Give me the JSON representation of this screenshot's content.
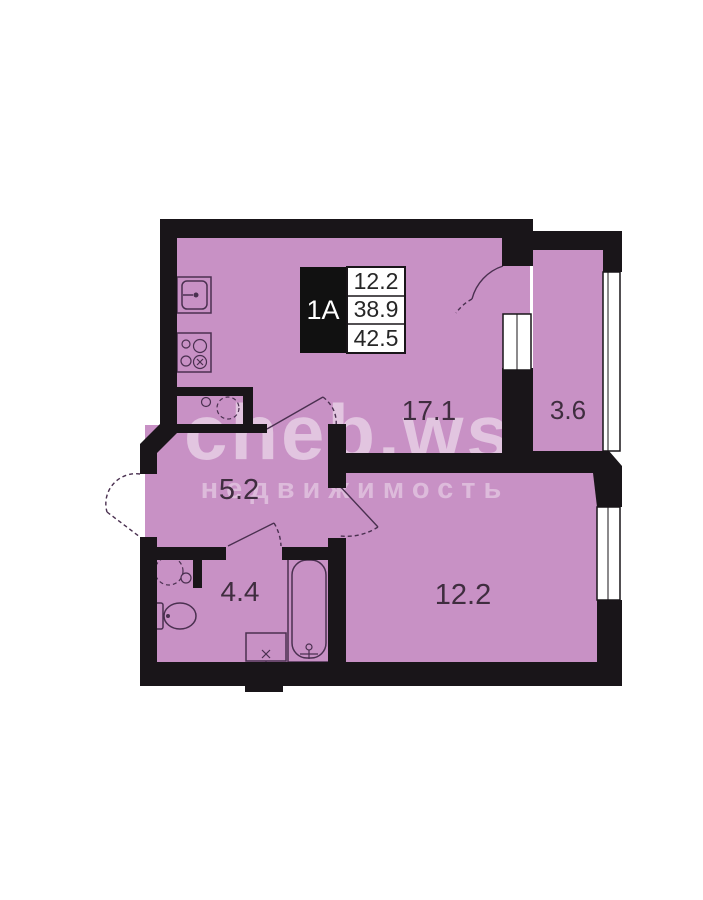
{
  "plan": {
    "unit": "1A",
    "info_values": [
      "12.2",
      "38.9",
      "42.5"
    ],
    "rooms": [
      {
        "id": "living-kitchen",
        "area": "17.1"
      },
      {
        "id": "balcony",
        "area": "3.6"
      },
      {
        "id": "hallway",
        "area": "5.2"
      },
      {
        "id": "bathroom",
        "area": "4.4"
      },
      {
        "id": "bedroom",
        "area": "12.2"
      }
    ]
  },
  "watermark": {
    "line1": "cheb.ws",
    "line2": "недвижимость"
  },
  "colors": {
    "page_bg": "#ffffff",
    "room_fill": "#c891c5",
    "wall": "#191519",
    "fixture_line": "#4a3050",
    "room_label": "#3f2d3f",
    "info_box_bg": "#111111",
    "info_unit_text": "#ffffff",
    "info_text": "#262626",
    "window_fill": "#ffffff",
    "watermark_fill": "rgba(255,255,255,0.47)",
    "watermark_fill2": "rgba(255,255,255,0.38)"
  }
}
